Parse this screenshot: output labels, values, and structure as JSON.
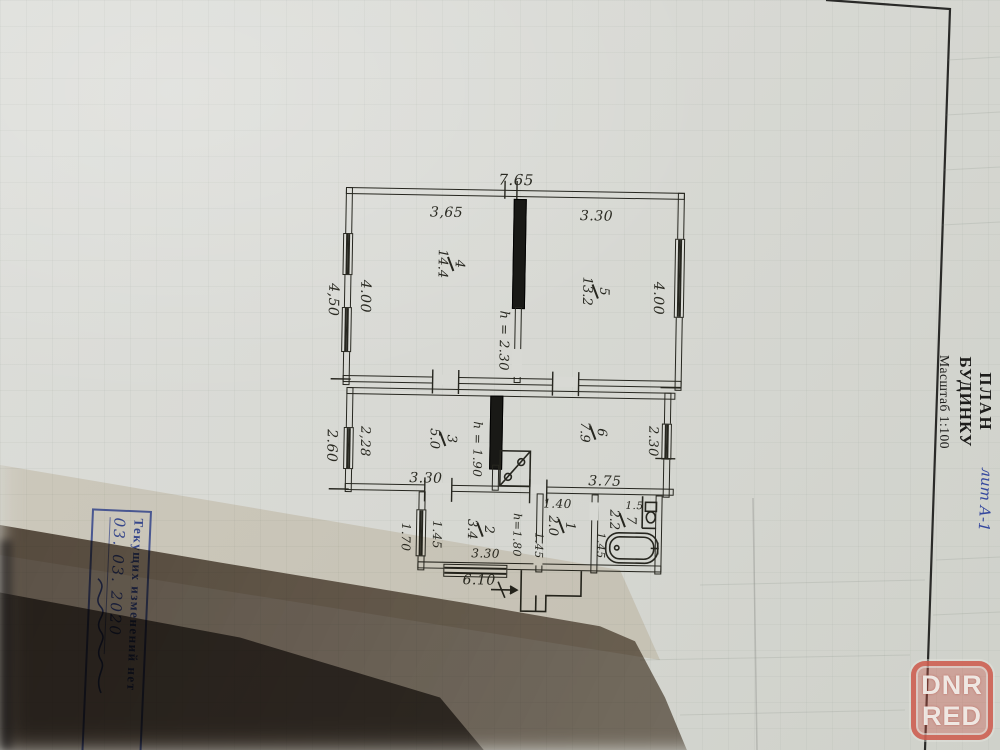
{
  "title_block": {
    "line1": "ПЛАН",
    "line2": "БУДИНКУ",
    "scale": "Масштаб 1:100",
    "handwritten_note": "лит А-1"
  },
  "stamp": {
    "text": "Текущих изменений нет",
    "date": "03. 03. 2020"
  },
  "watermark": {
    "line1": "DNR",
    "line2": "RED"
  },
  "plan": {
    "scale_text": "1:100",
    "dims": [
      {
        "t": "7.65",
        "x": 516,
        "y": 177,
        "r": 0,
        "s": 15
      },
      {
        "t": "3,65",
        "x": 447,
        "y": 211,
        "r": 0,
        "s": 14
      },
      {
        "t": "3.30",
        "x": 597,
        "y": 212,
        "r": 0,
        "s": 14
      },
      {
        "t": "4,50",
        "x": 335,
        "y": 300,
        "r": 90,
        "s": 14
      },
      {
        "t": "4.00",
        "x": 367,
        "y": 296,
        "r": 90,
        "s": 14
      },
      {
        "t": "4.00",
        "x": 660,
        "y": 293,
        "r": 90,
        "s": 14
      },
      {
        "t": "h = 2.30",
        "x": 506,
        "y": 338,
        "r": 90,
        "s": 13
      },
      {
        "t": "2.60",
        "x": 336,
        "y": 446,
        "r": 90,
        "s": 14
      },
      {
        "t": "2,28",
        "x": 369,
        "y": 441,
        "r": 90,
        "s": 13
      },
      {
        "t": "3.30",
        "x": 431,
        "y": 477,
        "r": 0,
        "s": 14
      },
      {
        "t": "h = 1.90",
        "x": 482,
        "y": 447,
        "r": 90,
        "s": 12
      },
      {
        "t": "3.75",
        "x": 610,
        "y": 477,
        "r": 0,
        "s": 14
      },
      {
        "t": "2.30",
        "x": 657,
        "y": 436,
        "r": 90,
        "s": 13
      },
      {
        "t": "1.70",
        "x": 412,
        "y": 536,
        "r": 90,
        "s": 12
      },
      {
        "t": "1.45",
        "x": 443,
        "y": 533,
        "r": 90,
        "s": 12
      },
      {
        "t": "3.30",
        "x": 492,
        "y": 551,
        "r": 0,
        "s": 12
      },
      {
        "t": "h=1.80",
        "x": 523,
        "y": 532,
        "r": 90,
        "s": 11
      },
      {
        "t": "1.45",
        "x": 545,
        "y": 542,
        "r": 90,
        "s": 11
      },
      {
        "t": "1.40",
        "x": 563,
        "y": 500,
        "r": 0,
        "s": 12
      },
      {
        "t": "1.45",
        "x": 607,
        "y": 541,
        "r": 90,
        "s": 11
      },
      {
        "t": "1.5",
        "x": 640,
        "y": 501,
        "r": 0,
        "s": 10.5
      },
      {
        "t": "6.10",
        "x": 486,
        "y": 578,
        "r": 0,
        "s": 14
      }
    ],
    "rooms": [
      {
        "num": "4",
        "area": "14.4",
        "x": 452,
        "y": 262
      },
      {
        "num": "5",
        "area": "13.2",
        "x": 597,
        "y": 287
      },
      {
        "num": "3",
        "area": "5.0",
        "x": 447,
        "y": 437
      },
      {
        "num": "6",
        "area": "7.9",
        "x": 597,
        "y": 428
      },
      {
        "num": "2",
        "area": "3.4",
        "x": 486,
        "y": 527
      },
      {
        "num": "1",
        "area": "2.0",
        "x": 567,
        "y": 522
      },
      {
        "num": "7",
        "area": "2.2",
        "x": 628,
        "y": 515
      }
    ]
  },
  "colors": {
    "paper": "#d8d9d4",
    "ink": "#26261f",
    "stamp_blue": "#3a4ea0",
    "watermark_red": "#c9574a",
    "shadow_brown": "#4a3e35"
  }
}
